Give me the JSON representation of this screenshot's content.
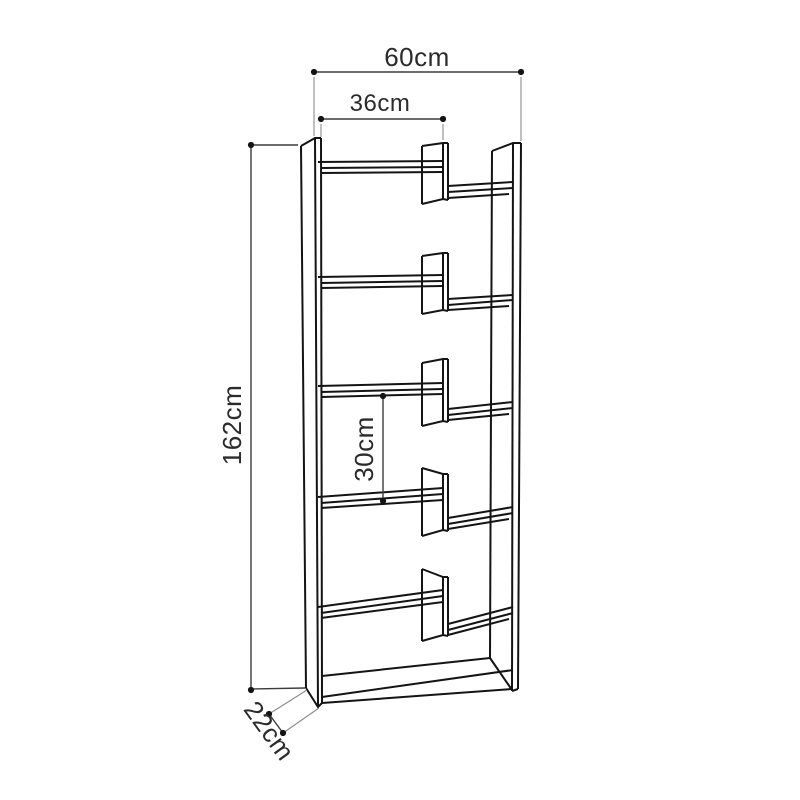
{
  "page": {
    "background": "#ffffff"
  },
  "drawing": {
    "subject": "staggered-shelf bookcase line drawing",
    "colors": {
      "outline": "#141414",
      "dimension_line": "#3c3c3c",
      "extension_line": "#8a8a8a",
      "label_text": "#2b2b2b",
      "background": "#ffffff"
    },
    "counts": {
      "side_panels": 2,
      "left_shelves": 5,
      "right_shelves": 5,
      "middle_dividers": 5,
      "bottom_shelf": 1
    }
  },
  "dimensions": {
    "overall_width": {
      "label": "60cm",
      "value": 60,
      "unit": "cm"
    },
    "inner_width": {
      "label": "36cm",
      "value": 36,
      "unit": "cm"
    },
    "overall_height": {
      "label": "162cm",
      "value": 162,
      "unit": "cm"
    },
    "shelf_spacing": {
      "label": "30cm",
      "value": 30,
      "unit": "cm"
    },
    "depth": {
      "label": "22cm",
      "value": 22,
      "unit": "cm"
    }
  }
}
